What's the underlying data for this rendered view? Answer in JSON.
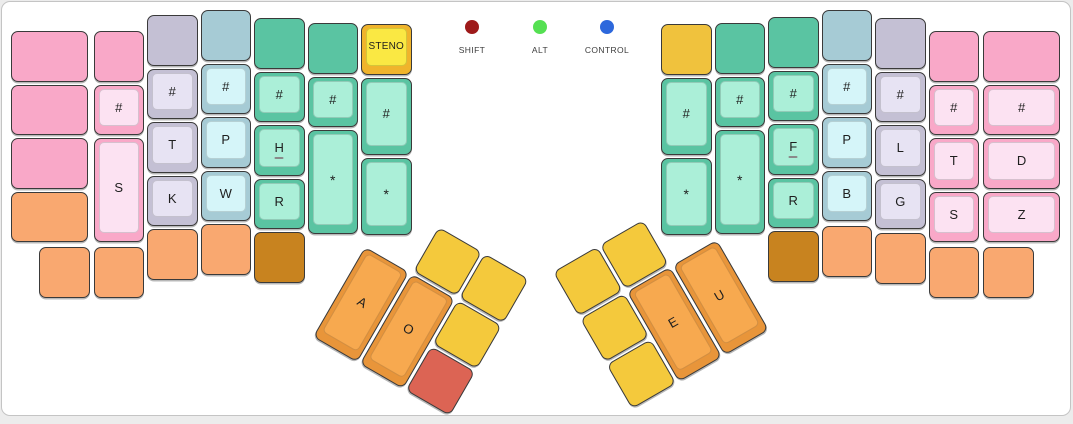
{
  "unit": 53.5,
  "gap": 3,
  "page": {
    "background": "#ececec",
    "card_background": "#ffffff",
    "card_border": "#c4c4c4",
    "key_border": "#3a3a3a"
  },
  "palettes": {
    "pink": {
      "base": "#F9A8C8",
      "cap": "#FCE2F2"
    },
    "lavender": {
      "base": "#C4C0D4",
      "cap": "#E7E3F3"
    },
    "blue": {
      "base": "#A6CBD5",
      "cap": "#D5F5F9"
    },
    "green": {
      "base": "#5AC4A2",
      "cap": "#ABEFD8"
    },
    "steno_yellow": {
      "base": "#F0B42C",
      "cap": "#FAE843"
    },
    "gold": {
      "base": "#F0C23D"
    },
    "orange": {
      "base": "#F9A870"
    },
    "brown": {
      "base": "#C8831F"
    },
    "thumb_orange": {
      "base": "#E8953A",
      "cap": "#F7A94F"
    },
    "thumb_yellow": {
      "base": "#F4C93C"
    },
    "red": {
      "base": "#DC6454"
    }
  },
  "indicators": [
    {
      "label": "SHIFT",
      "color": "#9E1A1A"
    },
    {
      "label": "ALT",
      "color": "#55E052"
    },
    {
      "label": "CONTROL",
      "color": "#2D68DC"
    }
  ],
  "main_keys": [
    {
      "x": 9,
      "y": 29,
      "w": 1.5,
      "h": 1,
      "palette": "pink",
      "label": "",
      "name": "blank-key"
    },
    {
      "x": 9,
      "y": 82.5,
      "w": 1.5,
      "h": 1,
      "palette": "pink",
      "label": "",
      "name": "blank-key"
    },
    {
      "x": 9,
      "y": 136,
      "w": 1.5,
      "h": 1,
      "palette": "pink",
      "label": "",
      "name": "blank-key"
    },
    {
      "x": 9,
      "y": 189.5,
      "w": 1.5,
      "h": 1,
      "palette": "orange",
      "label": "",
      "name": "blank-key"
    },
    {
      "x": 91.5,
      "y": 29,
      "w": 1,
      "h": 1,
      "palette": "pink",
      "label": "",
      "name": "blank-key"
    },
    {
      "x": 91.5,
      "y": 82.5,
      "w": 1,
      "h": 1,
      "palette": "pink",
      "label": "#",
      "name": "steno-number-key"
    },
    {
      "x": 91.5,
      "y": 136,
      "w": 1,
      "h": 2,
      "palette": "pink",
      "label": "S",
      "name": "steno-S-left-key"
    },
    {
      "x": 145,
      "y": 13,
      "w": 1,
      "h": 1,
      "palette": "lavender",
      "label": "",
      "name": "blank-key"
    },
    {
      "x": 145,
      "y": 66.5,
      "w": 1,
      "h": 1,
      "palette": "lavender",
      "label": "#",
      "name": "steno-number-key"
    },
    {
      "x": 145,
      "y": 120,
      "w": 1,
      "h": 1,
      "palette": "lavender",
      "label": "T",
      "name": "steno-T-left-key"
    },
    {
      "x": 145,
      "y": 173.5,
      "w": 1,
      "h": 1,
      "palette": "lavender",
      "label": "K",
      "name": "steno-K-key"
    },
    {
      "x": 145,
      "y": 227,
      "w": 1,
      "h": 1,
      "palette": "orange",
      "label": "",
      "name": "blank-key"
    },
    {
      "x": 198.5,
      "y": 8,
      "w": 1,
      "h": 1,
      "palette": "blue",
      "label": "",
      "name": "blank-key"
    },
    {
      "x": 198.5,
      "y": 61.5,
      "w": 1,
      "h": 1,
      "palette": "blue",
      "label": "#",
      "name": "steno-number-key"
    },
    {
      "x": 198.5,
      "y": 115,
      "w": 1,
      "h": 1,
      "palette": "blue",
      "label": "P",
      "name": "steno-P-left-key"
    },
    {
      "x": 198.5,
      "y": 168.5,
      "w": 1,
      "h": 1,
      "palette": "blue",
      "label": "W",
      "name": "steno-W-key"
    },
    {
      "x": 198.5,
      "y": 222,
      "w": 1,
      "h": 1,
      "palette": "orange",
      "label": "",
      "name": "blank-key"
    },
    {
      "x": 252,
      "y": 16,
      "w": 1,
      "h": 1,
      "palette": "green",
      "label": "",
      "name": "blank-key"
    },
    {
      "x": 252,
      "y": 69.5,
      "w": 1,
      "h": 1,
      "palette": "green",
      "label": "#",
      "name": "steno-number-key"
    },
    {
      "x": 252,
      "y": 123,
      "w": 1,
      "h": 1,
      "palette": "green",
      "label": "H",
      "name": "steno-H-key",
      "homing": true
    },
    {
      "x": 252,
      "y": 176.5,
      "w": 1,
      "h": 1,
      "palette": "green",
      "label": "R",
      "name": "steno-R-left-key"
    },
    {
      "x": 252,
      "y": 230,
      "w": 1,
      "h": 1,
      "palette": "brown",
      "label": "",
      "name": "blank-key"
    },
    {
      "x": 305.5,
      "y": 21,
      "w": 1,
      "h": 1,
      "palette": "green",
      "label": "",
      "name": "blank-key"
    },
    {
      "x": 305.5,
      "y": 74.5,
      "w": 1,
      "h": 1,
      "palette": "green",
      "label": "#",
      "name": "steno-number-key"
    },
    {
      "x": 305.5,
      "y": 128,
      "w": 1,
      "h": 2,
      "palette": "green",
      "label": "*",
      "name": "steno-star-key"
    },
    {
      "x": 359,
      "y": 22,
      "w": 1,
      "h": 1,
      "palette": "steno_yellow",
      "label": "STENO",
      "name": "steno-layer-key"
    },
    {
      "x": 359,
      "y": 75.5,
      "w": 1,
      "h": 1.5,
      "palette": "green",
      "label": "#",
      "name": "steno-number-key"
    },
    {
      "x": 359,
      "y": 155.75,
      "w": 1,
      "h": 1.5,
      "palette": "green",
      "label": "*",
      "name": "steno-star-key"
    },
    {
      "x": 37,
      "y": 245,
      "w": 1,
      "h": 1,
      "palette": "orange",
      "label": "",
      "name": "blank-key"
    },
    {
      "x": 91.5,
      "y": 245,
      "w": 1,
      "h": 1,
      "palette": "orange",
      "label": "",
      "name": "blank-key"
    },
    {
      "x": 659,
      "y": 22,
      "w": 1,
      "h": 1,
      "palette": "gold",
      "label": "",
      "name": "blank-key-gold"
    },
    {
      "x": 659,
      "y": 75.5,
      "w": 1,
      "h": 1.5,
      "palette": "green",
      "label": "#",
      "name": "steno-number-key"
    },
    {
      "x": 659,
      "y": 155.75,
      "w": 1,
      "h": 1.5,
      "palette": "green",
      "label": "*",
      "name": "steno-star-key"
    },
    {
      "x": 712.5,
      "y": 21,
      "w": 1,
      "h": 1,
      "palette": "green",
      "label": "",
      "name": "blank-key"
    },
    {
      "x": 712.5,
      "y": 74.5,
      "w": 1,
      "h": 1,
      "palette": "green",
      "label": "#",
      "name": "steno-number-key"
    },
    {
      "x": 712.5,
      "y": 128,
      "w": 1,
      "h": 2,
      "palette": "green",
      "label": "*",
      "name": "steno-star-key"
    },
    {
      "x": 766,
      "y": 15,
      "w": 1,
      "h": 1,
      "palette": "green",
      "label": "",
      "name": "blank-key"
    },
    {
      "x": 766,
      "y": 68.5,
      "w": 1,
      "h": 1,
      "palette": "green",
      "label": "#",
      "name": "steno-number-key"
    },
    {
      "x": 766,
      "y": 122,
      "w": 1,
      "h": 1,
      "palette": "green",
      "label": "F",
      "name": "steno-F-key",
      "homing": true
    },
    {
      "x": 766,
      "y": 175.5,
      "w": 1,
      "h": 1,
      "palette": "green",
      "label": "R",
      "name": "steno-R-right-key"
    },
    {
      "x": 766,
      "y": 229,
      "w": 1,
      "h": 1,
      "palette": "brown",
      "label": "",
      "name": "blank-key"
    },
    {
      "x": 819.5,
      "y": 8,
      "w": 1,
      "h": 1,
      "palette": "blue",
      "label": "",
      "name": "blank-key"
    },
    {
      "x": 819.5,
      "y": 61.5,
      "w": 1,
      "h": 1,
      "palette": "blue",
      "label": "#",
      "name": "steno-number-key"
    },
    {
      "x": 819.5,
      "y": 115,
      "w": 1,
      "h": 1,
      "palette": "blue",
      "label": "P",
      "name": "steno-P-right-key"
    },
    {
      "x": 819.5,
      "y": 168.5,
      "w": 1,
      "h": 1,
      "palette": "blue",
      "label": "B",
      "name": "steno-B-key"
    },
    {
      "x": 819.5,
      "y": 224,
      "w": 1,
      "h": 1,
      "palette": "orange",
      "label": "",
      "name": "blank-key"
    },
    {
      "x": 873,
      "y": 16,
      "w": 1,
      "h": 1,
      "palette": "lavender",
      "label": "",
      "name": "blank-key"
    },
    {
      "x": 873,
      "y": 69.5,
      "w": 1,
      "h": 1,
      "palette": "lavender",
      "label": "#",
      "name": "steno-number-key"
    },
    {
      "x": 873,
      "y": 123,
      "w": 1,
      "h": 1,
      "palette": "lavender",
      "label": "L",
      "name": "steno-L-key"
    },
    {
      "x": 873,
      "y": 176.5,
      "w": 1,
      "h": 1,
      "palette": "lavender",
      "label": "G",
      "name": "steno-G-key"
    },
    {
      "x": 873,
      "y": 231,
      "w": 1,
      "h": 1,
      "palette": "orange",
      "label": "",
      "name": "blank-key"
    },
    {
      "x": 926.5,
      "y": 29,
      "w": 1,
      "h": 1,
      "palette": "pink",
      "label": "",
      "name": "blank-key"
    },
    {
      "x": 926.5,
      "y": 82.5,
      "w": 1,
      "h": 1,
      "palette": "pink",
      "label": "#",
      "name": "steno-number-key"
    },
    {
      "x": 926.5,
      "y": 136,
      "w": 1,
      "h": 1,
      "palette": "pink",
      "label": "T",
      "name": "steno-T-right-key"
    },
    {
      "x": 926.5,
      "y": 189.5,
      "w": 1,
      "h": 1,
      "palette": "pink",
      "label": "S",
      "name": "steno-S-right-key"
    },
    {
      "x": 926.5,
      "y": 245,
      "w": 1,
      "h": 1,
      "palette": "orange",
      "label": "",
      "name": "blank-key"
    },
    {
      "x": 981,
      "y": 29,
      "w": 1.5,
      "h": 1,
      "palette": "pink",
      "label": "",
      "name": "blank-key"
    },
    {
      "x": 981,
      "y": 82.5,
      "w": 1.5,
      "h": 1,
      "palette": "pink",
      "label": "#",
      "name": "steno-number-key"
    },
    {
      "x": 981,
      "y": 136,
      "w": 1.5,
      "h": 1,
      "palette": "pink",
      "label": "D",
      "name": "steno-D-key"
    },
    {
      "x": 981,
      "y": 189.5,
      "w": 1.5,
      "h": 1,
      "palette": "pink",
      "label": "Z",
      "name": "steno-Z-key"
    },
    {
      "x": 981,
      "y": 245,
      "w": 1,
      "h": 1,
      "palette": "orange",
      "label": "",
      "name": "blank-key"
    }
  ],
  "thumb_clusters": [
    {
      "name": "left-thumb-cluster",
      "x": 390,
      "y": 198,
      "rotation": 30,
      "keys": [
        {
          "x": 53.5,
          "y": 0,
          "w": 1,
          "h": 1,
          "palette": "thumb_yellow",
          "label": "",
          "name": "blank-key"
        },
        {
          "x": 107,
          "y": 0,
          "w": 1,
          "h": 1,
          "palette": "thumb_yellow",
          "label": "",
          "name": "blank-key"
        },
        {
          "x": 0,
          "y": 53.5,
          "w": 1,
          "h": 2,
          "palette": "thumb_orange",
          "label": "A",
          "name": "steno-A-key"
        },
        {
          "x": 53.5,
          "y": 53.5,
          "w": 1,
          "h": 2,
          "palette": "thumb_orange",
          "label": "O",
          "name": "steno-O-key"
        },
        {
          "x": 107,
          "y": 53.5,
          "w": 1,
          "h": 1,
          "palette": "thumb_yellow",
          "label": "",
          "name": "blank-key"
        },
        {
          "x": 107,
          "y": 107,
          "w": 1,
          "h": 1,
          "palette": "red",
          "label": "",
          "name": "thumb-red-key"
        }
      ]
    },
    {
      "name": "right-thumb-cluster",
      "x": 551,
      "y": 270,
      "rotation": -30,
      "keys": [
        {
          "x": 0,
          "y": 0,
          "w": 1,
          "h": 1,
          "palette": "thumb_yellow",
          "label": "",
          "name": "blank-key"
        },
        {
          "x": 53.5,
          "y": 0,
          "w": 1,
          "h": 1,
          "palette": "thumb_yellow",
          "label": "",
          "name": "blank-key"
        },
        {
          "x": 0,
          "y": 53.5,
          "w": 1,
          "h": 1,
          "palette": "thumb_yellow",
          "label": "",
          "name": "blank-key"
        },
        {
          "x": 0,
          "y": 107,
          "w": 1,
          "h": 1,
          "palette": "thumb_yellow",
          "label": "",
          "name": "blank-key"
        },
        {
          "x": 53.5,
          "y": 53.5,
          "w": 1,
          "h": 2,
          "palette": "thumb_orange",
          "label": "E",
          "name": "steno-E-key"
        },
        {
          "x": 107,
          "y": 53.5,
          "w": 1,
          "h": 2,
          "palette": "thumb_orange",
          "label": "U",
          "name": "steno-U-key"
        }
      ]
    }
  ]
}
